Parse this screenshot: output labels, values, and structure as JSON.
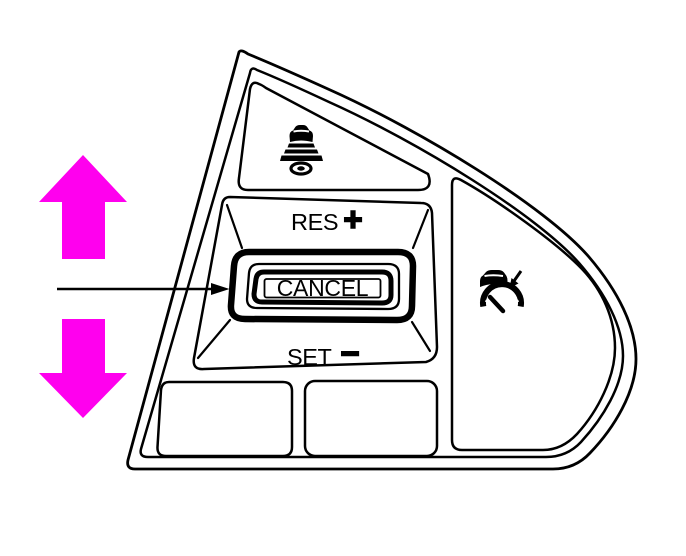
{
  "colors": {
    "arrow_highlight": "#ff00ee",
    "outline": "#000000",
    "background": "#ffffff"
  },
  "control_pad": {
    "distance_button": {
      "icon": "vehicle-distance-icon"
    },
    "res_button": {
      "label": "RES",
      "symbol": "+"
    },
    "cancel_button": {
      "label": "CANCEL"
    },
    "set_button": {
      "label": "SET",
      "symbol": "−"
    },
    "acc_button": {
      "icon": "adaptive-cruise-control-icon"
    }
  },
  "annotations": {
    "up_arrow": {
      "icon": "up-arrow",
      "color": "#ff00ee"
    },
    "down_arrow": {
      "icon": "down-arrow",
      "color": "#ff00ee"
    },
    "cancel_pointer": {
      "icon": "pointer-arrow",
      "color": "#000000"
    }
  }
}
